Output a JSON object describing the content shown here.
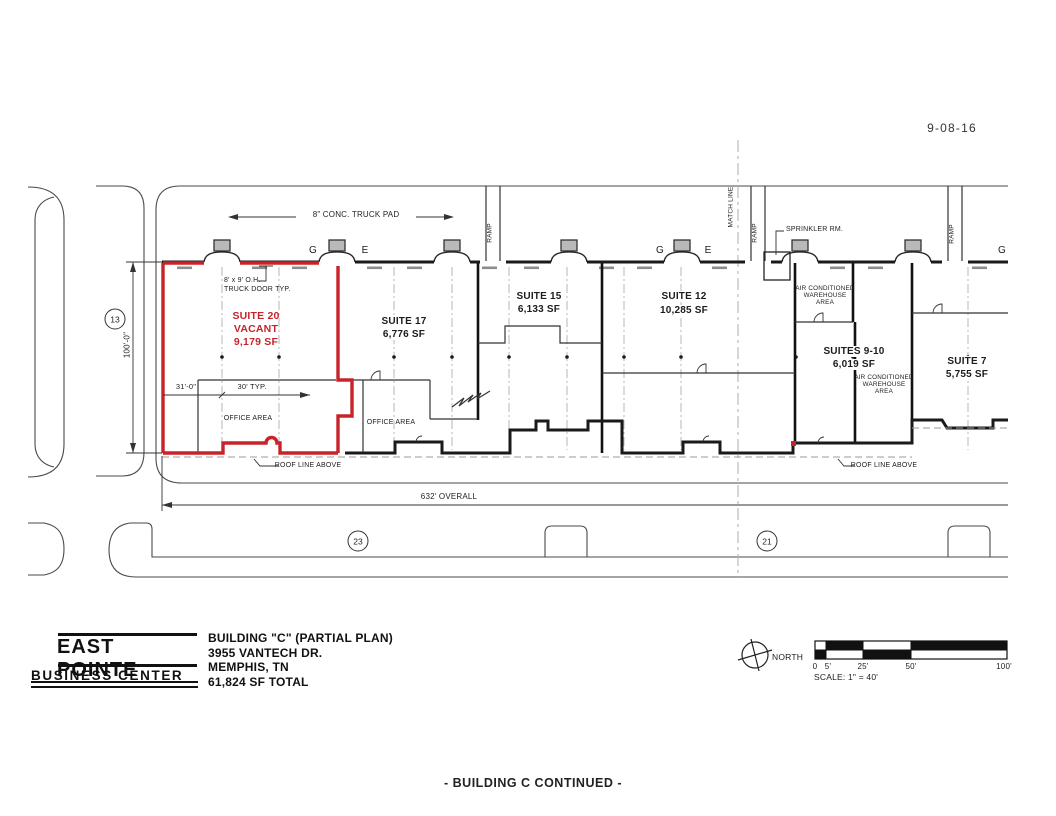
{
  "sheet": {
    "date": "9-08-16",
    "footer_note": "- BUILDING C CONTINUED -"
  },
  "title_block": {
    "logo_name": "EAST POINTE",
    "logo_subtitle": "BUSINESS CENTER",
    "plan_title": "BUILDING \"C\" (PARTIAL PLAN)",
    "address": "3955 VANTECH DR.",
    "city_state": "MEMPHIS, TN",
    "total_area": "61,824 SF TOTAL"
  },
  "north": {
    "label": "NORTH"
  },
  "scale_bar": {
    "ticks": [
      "0",
      "5'",
      "25'",
      "50'",
      "100'"
    ],
    "caption": "SCALE: 1\" = 40'"
  },
  "suites": [
    {
      "name": "SUITE 20",
      "status": "VACANT",
      "area": "9,179 SF"
    },
    {
      "name": "SUITE 17",
      "area": "6,776 SF"
    },
    {
      "name": "SUITE 15",
      "area": "6,133 SF"
    },
    {
      "name": "SUITE 12",
      "area": "10,285 SF"
    },
    {
      "name": "SUITES 9-10",
      "area": "6,019 SF"
    },
    {
      "name": "SUITE 7",
      "area": "5,755 SF"
    }
  ],
  "labels": {
    "truck_pad": "8\" CONC. TRUCK PAD",
    "truck_door_1": "8' x 9' O.H.",
    "truck_door_2": "TRUCK DOOR TYP.",
    "office_area": "OFFICE AREA",
    "roof_line": "ROOF LINE ABOVE",
    "sprinkler_room": "SPRINKLER RM.",
    "ac_wh_1": "AIR CONDITIONED",
    "ac_wh_2": "WAREHOUSE",
    "ac_wh_3": "AREA",
    "ramp": "RAMP",
    "match_line": "MATCH LINE",
    "door_letter_g": "G",
    "door_letter_e": "E"
  },
  "dimensions": {
    "overall": "632' OVERALL",
    "depth": "100'-0\"",
    "bay_first": "31'-0\"",
    "bay_typ": "30' TYP.",
    "keynote_13": "13",
    "keynote_23": "23",
    "keynote_21": "21"
  },
  "colors": {
    "vacant-highlight": "#c8232b",
    "line": "#2b2b2b",
    "muted-line": "#9b9b9b"
  }
}
